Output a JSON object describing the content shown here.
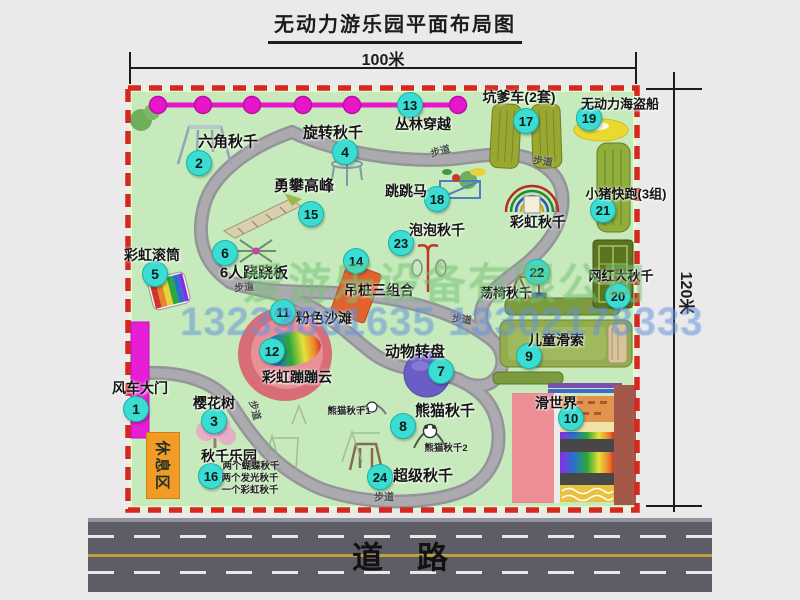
{
  "title": "无动力游乐园平面布局图",
  "dimensions": {
    "width_label": "100米",
    "height_label": "120米"
  },
  "road": {
    "label": "道路"
  },
  "watermark": {
    "company": "爱游乐设备有限公司",
    "phone": "13233861635 13302178333"
  },
  "rest_area": {
    "label": "休息区"
  },
  "path_label_text": "步道",
  "path_labels": [
    {
      "x": 440,
      "y": 150,
      "rot": -15
    },
    {
      "x": 543,
      "y": 160,
      "rot": 8
    },
    {
      "x": 244,
      "y": 286,
      "rot": -5
    },
    {
      "x": 256,
      "y": 410,
      "rot": 75
    },
    {
      "x": 462,
      "y": 318,
      "rot": 8
    },
    {
      "x": 384,
      "y": 496,
      "rot": 0
    }
  ],
  "attractions": [
    {
      "num": 1,
      "label": "风车大门",
      "cx": 136,
      "cy": 409,
      "lx": 140,
      "ly": 388,
      "fs": 14
    },
    {
      "num": 2,
      "label": "六角秋千",
      "cx": 199,
      "cy": 163,
      "lx": 228,
      "ly": 141,
      "fs": 15
    },
    {
      "num": 3,
      "label": "樱花树",
      "cx": 214,
      "cy": 421,
      "lx": 214,
      "ly": 403,
      "fs": 14
    },
    {
      "num": 4,
      "label": "旋转秋千",
      "cx": 345,
      "cy": 152,
      "lx": 333,
      "ly": 132,
      "fs": 15
    },
    {
      "num": 5,
      "label": "彩虹滚筒",
      "cx": 155,
      "cy": 274,
      "lx": 152,
      "ly": 255,
      "fs": 14
    },
    {
      "num": 6,
      "label": "6人跷跷板",
      "cx": 225,
      "cy": 253,
      "lx": 254,
      "ly": 272,
      "fs": 15
    },
    {
      "num": 7,
      "label": "动物转盘",
      "cx": 441,
      "cy": 371,
      "lx": 415,
      "ly": 351,
      "fs": 15
    },
    {
      "num": 8,
      "label": "熊猫秋千",
      "cx": 403,
      "cy": 426,
      "lx": 445,
      "ly": 410,
      "fs": 15
    },
    {
      "num": 9,
      "label": "儿童滑索",
      "cx": 529,
      "cy": 356,
      "lx": 556,
      "ly": 340,
      "fs": 14
    },
    {
      "num": 10,
      "label": "滑世界",
      "cx": 571,
      "cy": 418,
      "lx": 556,
      "ly": 403,
      "fs": 14
    },
    {
      "num": 11,
      "label": "粉色沙滩",
      "cx": 283,
      "cy": 312,
      "lx": 324,
      "ly": 318,
      "fs": 14
    },
    {
      "num": 12,
      "label": "彩虹蹦蹦云",
      "cx": 272,
      "cy": 351,
      "lx": 297,
      "ly": 377,
      "fs": 14
    },
    {
      "num": 13,
      "label": "丛林穿越",
      "cx": 410,
      "cy": 105,
      "lx": 423,
      "ly": 124,
      "fs": 14
    },
    {
      "num": 14,
      "label": "吊桩三组合",
      "cx": 356,
      "cy": 261,
      "lx": 379,
      "ly": 290,
      "fs": 14
    },
    {
      "num": 15,
      "label": "勇攀高峰",
      "cx": 311,
      "cy": 214,
      "lx": 304,
      "ly": 185,
      "fs": 15
    },
    {
      "num": 16,
      "label": "秋千乐园",
      "cx": 211,
      "cy": 476,
      "lx": 229,
      "ly": 456,
      "fs": 14
    },
    {
      "num": 17,
      "label": "坑爹车(2套)",
      "cx": 526,
      "cy": 121,
      "lx": 519,
      "ly": 97,
      "fs": 14
    },
    {
      "num": 18,
      "label": "跳跳马",
      "cx": 437,
      "cy": 199,
      "lx": 406,
      "ly": 191,
      "fs": 14
    },
    {
      "num": 19,
      "label": "无动力海盗船",
      "cx": 589,
      "cy": 118,
      "lx": 620,
      "ly": 103,
      "fs": 13
    },
    {
      "num": 20,
      "label": "网红大秋千",
      "cx": 618,
      "cy": 296,
      "lx": 621,
      "ly": 275,
      "fs": 13
    },
    {
      "num": 21,
      "label": "小猪快跑(3组)",
      "cx": 603,
      "cy": 210,
      "lx": 626,
      "ly": 193,
      "fs": 13
    },
    {
      "num": 22,
      "label": "荡椅秋千",
      "cx": 537,
      "cy": 272,
      "lx": 506,
      "ly": 292,
      "fs": 13
    },
    {
      "num": 23,
      "label": "泡泡秋千",
      "cx": 401,
      "cy": 243,
      "lx": 437,
      "ly": 230,
      "fs": 14
    },
    {
      "num": 24,
      "label": "超级秋千",
      "cx": 380,
      "cy": 477,
      "lx": 423,
      "ly": 475,
      "fs": 15
    },
    {
      "num": null,
      "label": "彩虹秋千",
      "cx": null,
      "cy": null,
      "lx": 538,
      "ly": 222,
      "fs": 14
    }
  ],
  "notes": [
    {
      "text": "熊猫秋千1",
      "x": 349,
      "y": 410
    },
    {
      "text": "熊猫秋千2",
      "x": 446,
      "y": 447
    },
    {
      "text": "两个蝴蝶秋千",
      "x": 251,
      "y": 465
    },
    {
      "text": "两个发光秋千",
      "x": 250,
      "y": 477
    },
    {
      "text": "一个彩虹秋千",
      "x": 250,
      "y": 489
    }
  ],
  "icons": {
    "gate": "magenta-bar",
    "jungle-line": "magenta-rope-with-dots",
    "pirate-ship": "yellow-ellipse",
    "animal-turntable": "purple-circle",
    "pink-beach": "pink-oval",
    "rainbow-cloud": "rainbow-blob",
    "rainbow-swing": "concentric-arcs",
    "slide-world": "striped-slide-block"
  },
  "colors": {
    "park_green": "#c6eabb",
    "path_gray": "#a2a2a7",
    "border_red": "#d6281e",
    "marker_cyan": "#3bdcd2",
    "magenta": "#e816cb",
    "road_gray": "#5d5d66",
    "rest_orange": "#f29c27",
    "olive_green": "#8fae3a"
  }
}
